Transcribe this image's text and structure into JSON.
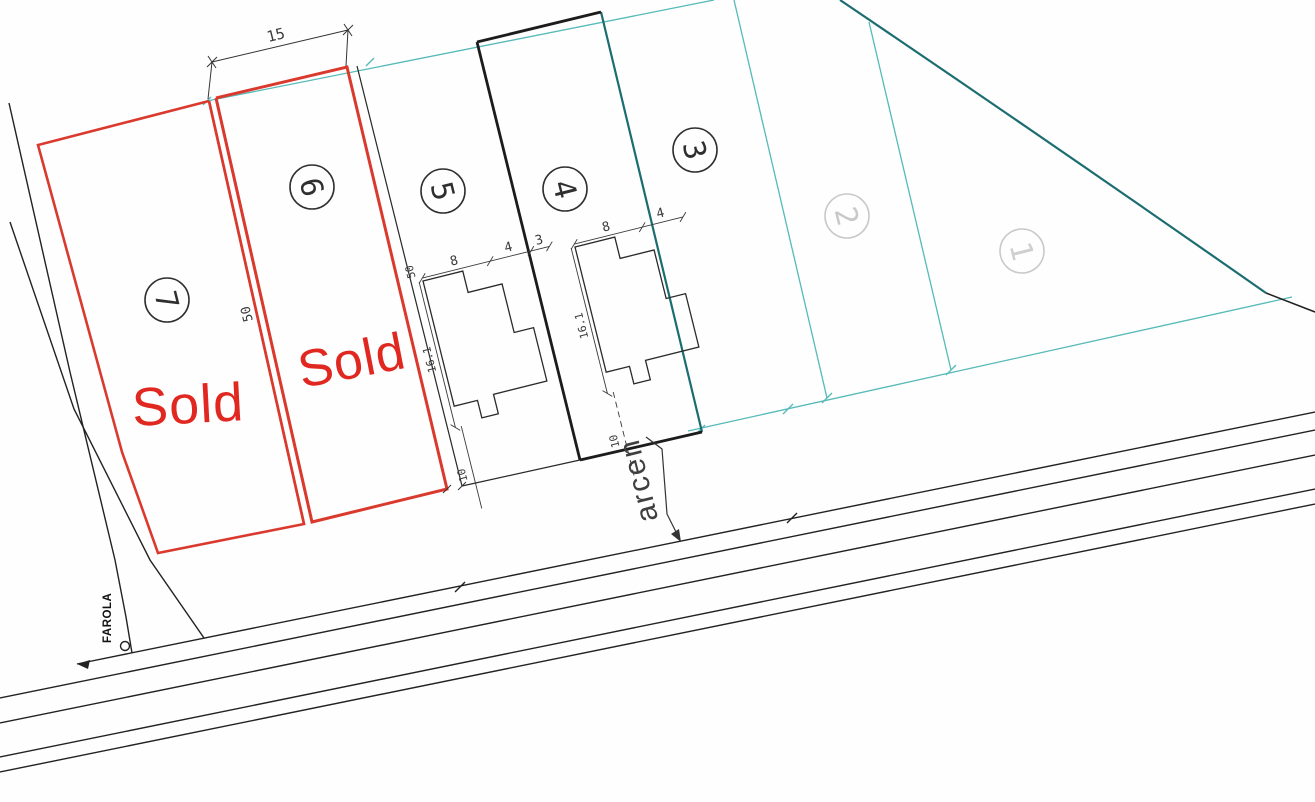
{
  "plan": {
    "plots": [
      {
        "number": "1"
      },
      {
        "number": "2"
      },
      {
        "number": "3"
      },
      {
        "number": "4"
      },
      {
        "number": "5"
      },
      {
        "number": "6"
      },
      {
        "number": "7"
      }
    ],
    "sold_labels": {
      "plot7": "Sold",
      "plot6": "Sold"
    },
    "street_labels": {
      "shoulder": "arcen",
      "streetlight": "FAROLA"
    },
    "dimensions": {
      "plot_frontage": "15",
      "plot_depth": "50",
      "house_block_start": "50",
      "house5_width": "8",
      "house5_side": "4",
      "house5_depth": "16.1",
      "house5_setback": "10",
      "houses_gap": "3",
      "house4_width": "8",
      "house4_side": "4",
      "house4_depth": "16.1",
      "house4_setback": "10"
    },
    "colors": {
      "sold_red": "#e02820",
      "boundary_red": "#da3a2e",
      "boundary_cyan": "#55bab8",
      "boundary_dark_teal": "#1b6d70",
      "line_black": "#222222",
      "dark_number": "#2f2f2f",
      "muted_number": "#c9c9c9"
    }
  }
}
